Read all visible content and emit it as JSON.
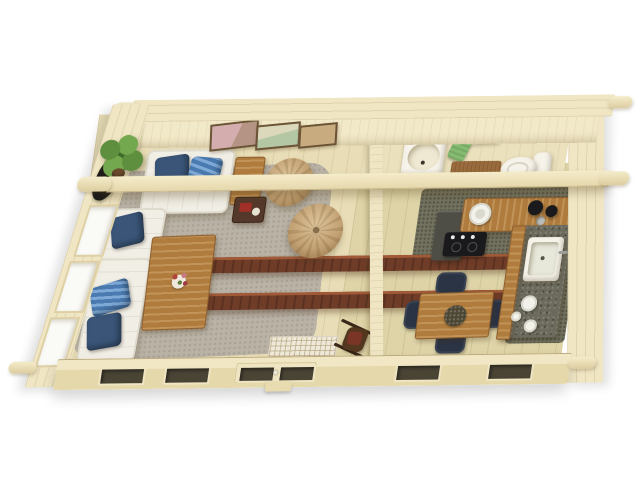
{
  "scene": {
    "title": "Top-down 3D floor plan of a one-room log cabin with living room, kitchen-dining area and bathroom",
    "view": "aerial cutaway 3D render",
    "background": "#ffffff"
  },
  "theme": {
    "wall": "#f0e6c4",
    "backWallFace": "#f2e9c9",
    "floorLiving": "#e8ddb6",
    "floorKitchen": "#ded4a8",
    "floorBath": "#ebe1bd",
    "rug": "#b9b2a5",
    "tile": "#73725f",
    "beamDark": "#6f3c28",
    "beamDarkHi": "#a05a38",
    "oak": "#b07c3e",
    "granite": "#6b6a5c",
    "sofaWhite": "#f1eee5",
    "sofaShade": "#dedacd",
    "pillowNavy": "#3a5578",
    "pillowBlue": "#4a7ab0",
    "pillowBlueLight": "#7fa9d6",
    "pouf": "#c2a173",
    "plantGreen": "#5d8f3e",
    "plantDark": "#3f6b2a",
    "porcelain": "#f6f3ea",
    "towel": "#85bb70",
    "matBrown": "#9a6b3d",
    "chairNavy": "#2b3445",
    "doorDark": "#4a4435",
    "darkWood": "#54392a",
    "black": "#1a1a1c",
    "artPink": "#d4aeae",
    "artGreen": "#b3c7a4",
    "artTan": "#c8ab7e"
  },
  "structure": {
    "walls": "interlocking log walls, cream timber",
    "beams": [
      "roof purlin across full width",
      "dark tie beam 1",
      "dark tie beam 2"
    ],
    "partition": "full-height partition between living room and kitchen / bathroom",
    "front_openings": [
      "window",
      "window",
      "double glass door with doormat inside",
      "window",
      "window"
    ],
    "left_wall_openings": [
      "window",
      "window",
      "window"
    ]
  },
  "rooms": [
    {
      "name": "living room",
      "furniture": [
        "loveseat with navy and striped blue cushions",
        "corner sofa with navy and striped blue cushions",
        "wooden coffee table with flower vase",
        "wooden side table",
        "dark side table with books",
        "grey shaggy rug",
        "knitted pouf",
        "knitted pouf",
        "potted plant",
        "pink abstract wall art",
        "green landscape wall art",
        "tan wall art",
        "dark wall mirror",
        "rocking chair",
        "patterned doormat"
      ]
    },
    {
      "name": "bathroom",
      "furniture": [
        "washbasin cabinet",
        "wall shelf",
        "mirror",
        "green hand towel",
        "brown bath mat",
        "toilet"
      ]
    },
    {
      "name": "kitchen-dining",
      "furniture": [
        "L-shaped oak counter with granite top",
        "dark base cabinet",
        "black cooktop with knobs",
        "round serving plate",
        "black kettle and pot",
        "square kitchen sink with tap",
        "teapot cups and plates",
        "oak dining table with dark wreath centerpiece",
        "navy dining chair",
        "navy dining chair",
        "navy dining chair",
        "navy dining chair"
      ]
    }
  ]
}
